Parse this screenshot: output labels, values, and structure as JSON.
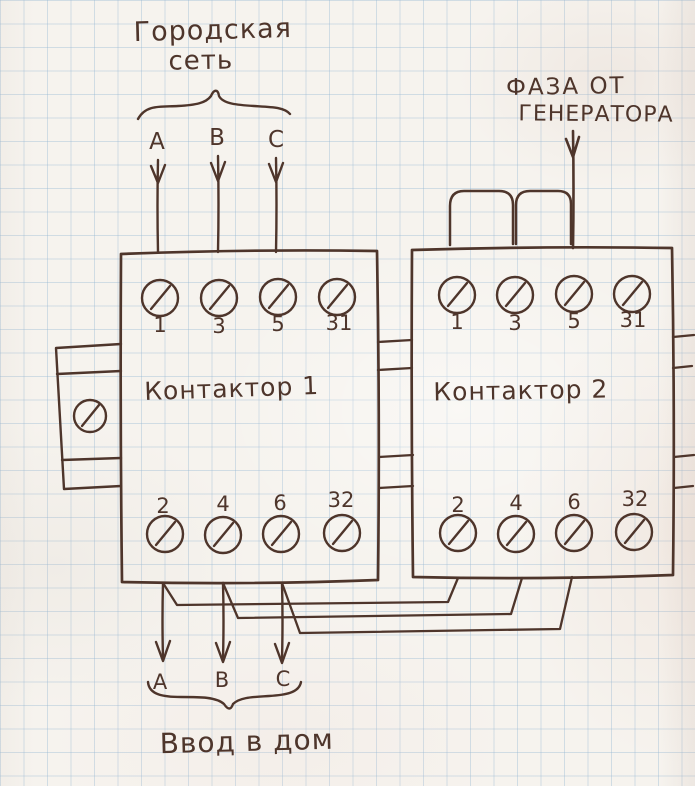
{
  "colors": {
    "ink": "#4e352b",
    "grid": "#bfd3e2",
    "paper": "#f6f3ee"
  },
  "city_network": {
    "label_line1": "Городская",
    "label_line2": "сеть",
    "phases": [
      "A",
      "B",
      "C"
    ]
  },
  "generator": {
    "label_line1": "ФАЗА ОТ",
    "label_line2": "ГЕНЕРАТОРА"
  },
  "contactor1": {
    "name": "Контактор 1",
    "top_terminals": [
      "1",
      "3",
      "5",
      "31"
    ],
    "bottom_terminals": [
      "2",
      "4",
      "6",
      "32"
    ]
  },
  "contactor2": {
    "name": "Контактор 2",
    "top_terminals": [
      "1",
      "3",
      "5",
      "31"
    ],
    "bottom_terminals": [
      "2",
      "4",
      "6",
      "32"
    ]
  },
  "house_input": {
    "phases": [
      "A",
      "B",
      "C"
    ],
    "label": "Ввод в дом"
  }
}
